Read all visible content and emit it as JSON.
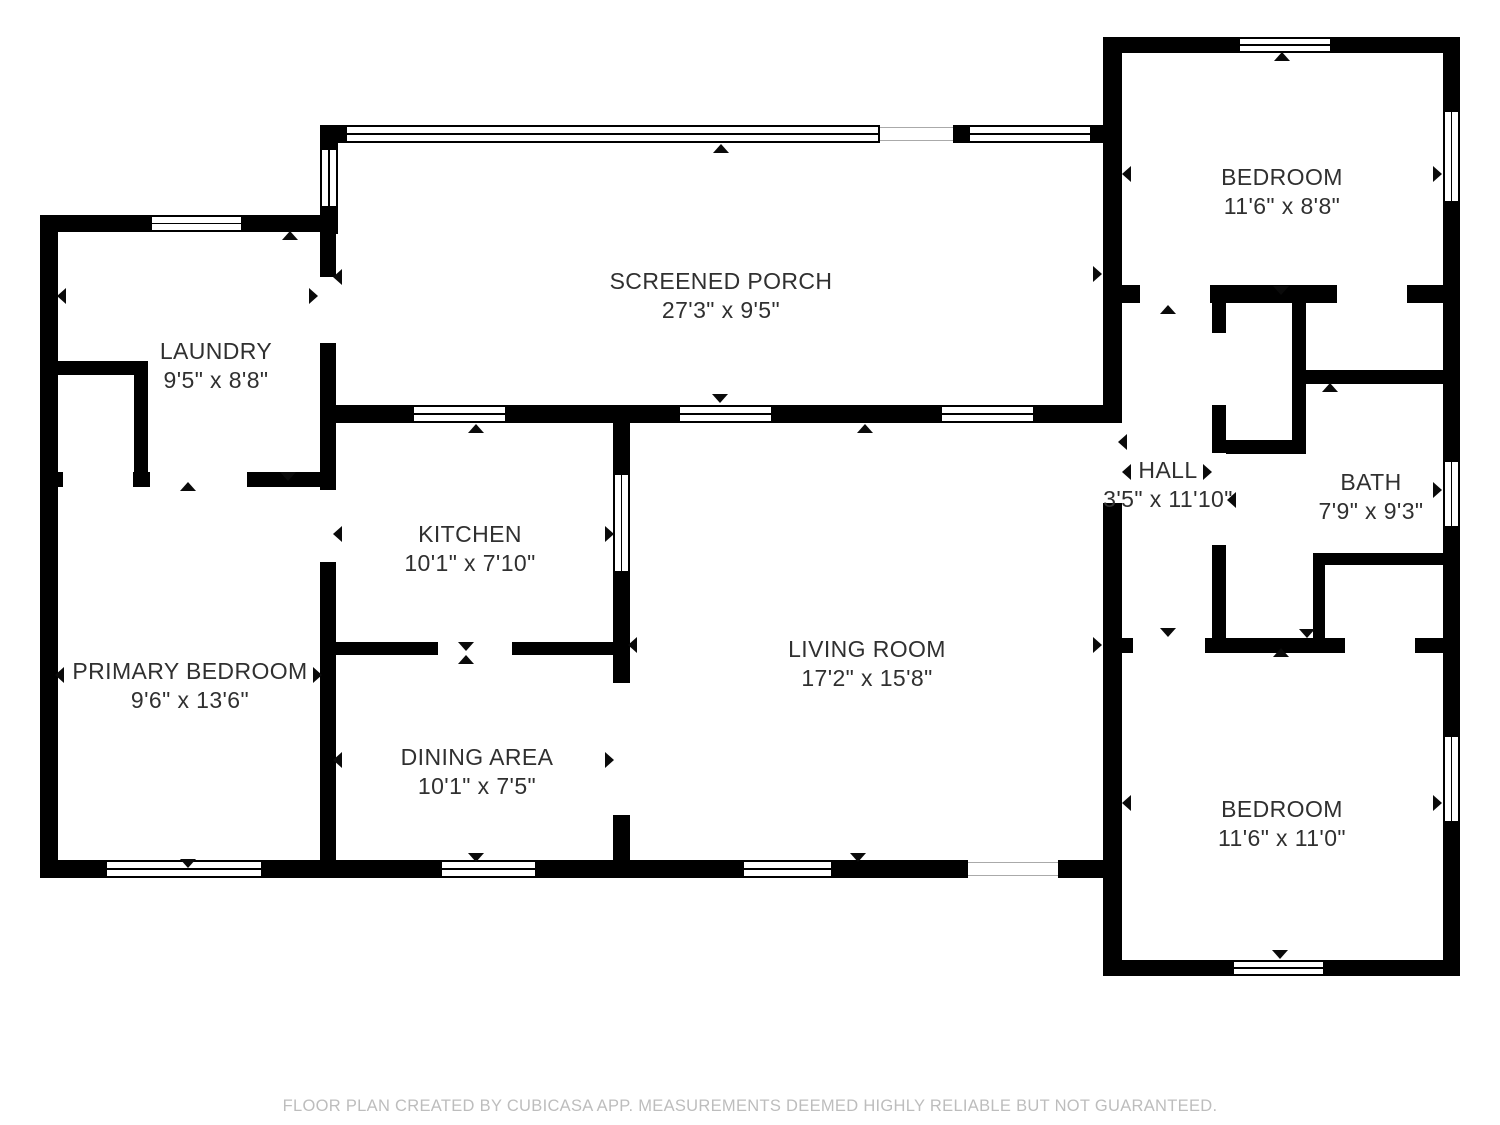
{
  "title": "Floor plan",
  "footer": {
    "text": "FLOOR PLAN CREATED BY CUBICASA APP. MEASUREMENTS DEEMED HIGHLY RELIABLE BUT NOT GUARANTEED."
  },
  "colors": {
    "background": "#ffffff",
    "wall": "#000000",
    "label": "#303030",
    "footer_text": "#bdbdbd"
  },
  "rooms": [
    {
      "id": "laundry",
      "name": "LAUNDRY",
      "dims": "9'5\" x 8'8\"",
      "label_x": 216,
      "label_y": 366
    },
    {
      "id": "screened-porch",
      "name": "SCREENED PORCH",
      "dims": "27'3\" x 9'5\"",
      "label_x": 721,
      "label_y": 296
    },
    {
      "id": "bedroom-top",
      "name": "BEDROOM",
      "dims": "11'6\" x 8'8\"",
      "label_x": 1282,
      "label_y": 192
    },
    {
      "id": "kitchen",
      "name": "KITCHEN",
      "dims": "10'1\" x 7'10\"",
      "label_x": 470,
      "label_y": 549
    },
    {
      "id": "hall",
      "name": "HALL",
      "dims": "3'5\" x 11'10\"",
      "label_x": 1168,
      "label_y": 485
    },
    {
      "id": "bath",
      "name": "BATH",
      "dims": "7'9\" x 9'3\"",
      "label_x": 1371,
      "label_y": 497
    },
    {
      "id": "primary-bedroom",
      "name": "PRIMARY BEDROOM",
      "dims": "9'6\" x 13'6\"",
      "label_x": 190,
      "label_y": 686
    },
    {
      "id": "living-room",
      "name": "LIVING ROOM",
      "dims": "17'2\" x 15'8\"",
      "label_x": 867,
      "label_y": 664
    },
    {
      "id": "dining-area",
      "name": "DINING AREA",
      "dims": "10'1\" x 7'5\"",
      "label_x": 477,
      "label_y": 772
    },
    {
      "id": "bedroom-bottom",
      "name": "BEDROOM",
      "dims": "11'6\" x 11'0\"",
      "label_x": 1282,
      "label_y": 824
    }
  ],
  "geometry": {
    "walls": [
      [
        40,
        215,
        18,
        663
      ],
      [
        40,
        215,
        292,
        17
      ],
      [
        40,
        860,
        292,
        18
      ],
      [
        40,
        472,
        23,
        15
      ],
      [
        133,
        472,
        17,
        15
      ],
      [
        247,
        472,
        85,
        15
      ],
      [
        58,
        361,
        90,
        14
      ],
      [
        134,
        361,
        14,
        126
      ],
      [
        320,
        215,
        16,
        62
      ],
      [
        320,
        343,
        16,
        147
      ],
      [
        320,
        562,
        16,
        298
      ],
      [
        320,
        125,
        25,
        18
      ],
      [
        953,
        125,
        15,
        18
      ],
      [
        1092,
        125,
        30,
        18
      ],
      [
        320,
        125,
        18,
        23
      ],
      [
        320,
        208,
        18,
        26
      ],
      [
        438,
        125,
        12,
        18
      ],
      [
        546,
        125,
        12,
        18
      ],
      [
        663,
        125,
        12,
        18
      ],
      [
        759,
        125,
        12,
        18
      ],
      [
        866,
        125,
        14,
        18
      ],
      [
        320,
        405,
        92,
        18
      ],
      [
        507,
        405,
        171,
        18
      ],
      [
        773,
        405,
        167,
        18
      ],
      [
        1035,
        405,
        87,
        18
      ],
      [
        613,
        423,
        17,
        50
      ],
      [
        613,
        573,
        17,
        110
      ],
      [
        613,
        815,
        17,
        62
      ],
      [
        332,
        642,
        106,
        13
      ],
      [
        512,
        642,
        118,
        13
      ],
      [
        332,
        860,
        108,
        18
      ],
      [
        537,
        860,
        205,
        18
      ],
      [
        833,
        860,
        135,
        18
      ],
      [
        1058,
        860,
        64,
        18
      ],
      [
        1103,
        37,
        19,
        248
      ],
      [
        1103,
        285,
        19,
        138
      ],
      [
        1103,
        503,
        19,
        457
      ],
      [
        1103,
        37,
        357,
        16
      ],
      [
        1443,
        37,
        17,
        939
      ],
      [
        1103,
        285,
        37,
        18
      ],
      [
        1210,
        285,
        127,
        18
      ],
      [
        1407,
        285,
        53,
        18
      ],
      [
        1212,
        295,
        14,
        38
      ],
      [
        1212,
        405,
        14,
        48
      ],
      [
        1212,
        545,
        14,
        108
      ],
      [
        1292,
        303,
        14,
        150
      ],
      [
        1226,
        440,
        80,
        14
      ],
      [
        1306,
        370,
        137,
        14
      ],
      [
        1313,
        553,
        130,
        12
      ],
      [
        1313,
        553,
        12,
        97
      ],
      [
        1103,
        638,
        30,
        15
      ],
      [
        1205,
        638,
        140,
        15
      ],
      [
        1415,
        638,
        28,
        15
      ],
      [
        1103,
        960,
        357,
        16
      ]
    ],
    "windows": [
      [
        150,
        215,
        93,
        17
      ],
      [
        105,
        860,
        158,
        18
      ],
      [
        440,
        860,
        97,
        18
      ],
      [
        742,
        860,
        91,
        18
      ],
      [
        345,
        125,
        535,
        18
      ],
      [
        968,
        125,
        124,
        18
      ],
      [
        412,
        405,
        95,
        18
      ],
      [
        678,
        405,
        95,
        18
      ],
      [
        940,
        405,
        95,
        18
      ],
      [
        320,
        148,
        18,
        60
      ],
      [
        613,
        473,
        17,
        100
      ],
      [
        1443,
        110,
        17,
        93
      ],
      [
        1443,
        460,
        17,
        68
      ],
      [
        1443,
        735,
        17,
        88
      ],
      [
        1238,
        37,
        94,
        16
      ],
      [
        1232,
        960,
        93,
        16
      ]
    ],
    "openings": [
      [
        880,
        127,
        73,
        14
      ],
      [
        968,
        862,
        90,
        14
      ]
    ],
    "door_arrows": [
      [
        290,
        236,
        "up"
      ],
      [
        62,
        296,
        "left"
      ],
      [
        314,
        296,
        "right"
      ],
      [
        288,
        477,
        "down"
      ],
      [
        188,
        487,
        "up"
      ],
      [
        60,
        675,
        "left"
      ],
      [
        318,
        675,
        "right"
      ],
      [
        188,
        864,
        "down"
      ],
      [
        338,
        277,
        "left"
      ],
      [
        1098,
        274,
        "right"
      ],
      [
        721,
        149,
        "up"
      ],
      [
        720,
        399,
        "down"
      ],
      [
        476,
        429,
        "up"
      ],
      [
        338,
        534,
        "left"
      ],
      [
        610,
        534,
        "right"
      ],
      [
        466,
        647,
        "down"
      ],
      [
        466,
        660,
        "up"
      ],
      [
        338,
        760,
        "left"
      ],
      [
        610,
        760,
        "right"
      ],
      [
        476,
        858,
        "down"
      ],
      [
        865,
        429,
        "up"
      ],
      [
        633,
        645,
        "left"
      ],
      [
        1098,
        645,
        "right"
      ],
      [
        858,
        858,
        "down"
      ],
      [
        1168,
        310,
        "up"
      ],
      [
        1127,
        472,
        "left"
      ],
      [
        1208,
        472,
        "right"
      ],
      [
        1168,
        633,
        "down"
      ],
      [
        1330,
        388,
        "up"
      ],
      [
        1232,
        500,
        "left"
      ],
      [
        1438,
        490,
        "right"
      ],
      [
        1307,
        634,
        "down"
      ],
      [
        1282,
        57,
        "up"
      ],
      [
        1127,
        174,
        "left"
      ],
      [
        1438,
        174,
        "right"
      ],
      [
        1281,
        291,
        "down"
      ],
      [
        1281,
        653,
        "up"
      ],
      [
        1127,
        803,
        "left"
      ],
      [
        1438,
        803,
        "right"
      ],
      [
        1280,
        955,
        "down"
      ],
      [
        1123,
        442,
        "left"
      ]
    ]
  }
}
